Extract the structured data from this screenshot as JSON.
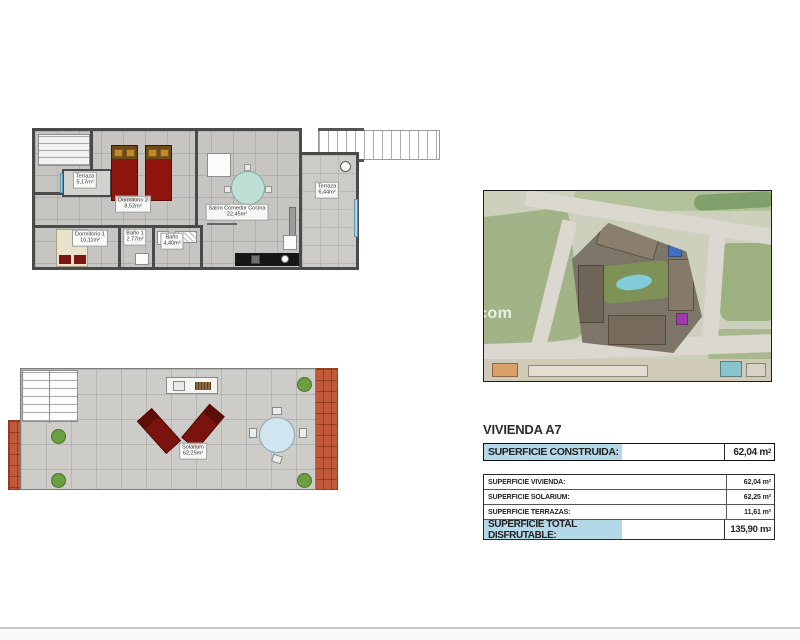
{
  "floorplan": {
    "rooms": [
      {
        "name": "Terraza",
        "area": "5,17m²"
      },
      {
        "name": "Dormitorio 2",
        "area": "8,52m²"
      },
      {
        "name": "Dormitorio 1",
        "area": "10,11m²"
      },
      {
        "name": "Baño 1",
        "area": "2,77m²"
      },
      {
        "name": "Baño",
        "area": "4,40m²"
      },
      {
        "name": "Salón  Comedor  Cocina",
        "area": "22,45m²"
      },
      {
        "name": "Terraza",
        "area": "6,44m²"
      }
    ]
  },
  "solarium_plan": {
    "room": {
      "name": "Solarium",
      "area": "62,25m²"
    }
  },
  "satellite": {
    "watermark": "com"
  },
  "details": {
    "title": "VIVIENDA A7",
    "built": {
      "label": "SUPERFICIE CONSTRUIDA:",
      "value": "62,04",
      "unit_base": "m",
      "unit_exp": "2"
    },
    "rows": [
      {
        "label": "SUPERFICIE VIVIENDA:",
        "value": "62,04 m²"
      },
      {
        "label": "SUPERFICIE SOLARIUM:",
        "value": "62,25 m²"
      },
      {
        "label": "SUPERFICIE TERRAZAS:",
        "value": "11,61 m²"
      }
    ],
    "total": {
      "label": "SUPERFICIE TOTAL DISFRUTABLE:",
      "value": "135,90",
      "unit_base": "m",
      "unit_exp": "2"
    }
  },
  "colors": {
    "highlight_blue": "#b5d8e9",
    "wall_gray": "#4a4a4a",
    "roof_tile": "#c2593a",
    "bed_red": "#8e150c",
    "pool_blue": "#82ccd8"
  }
}
